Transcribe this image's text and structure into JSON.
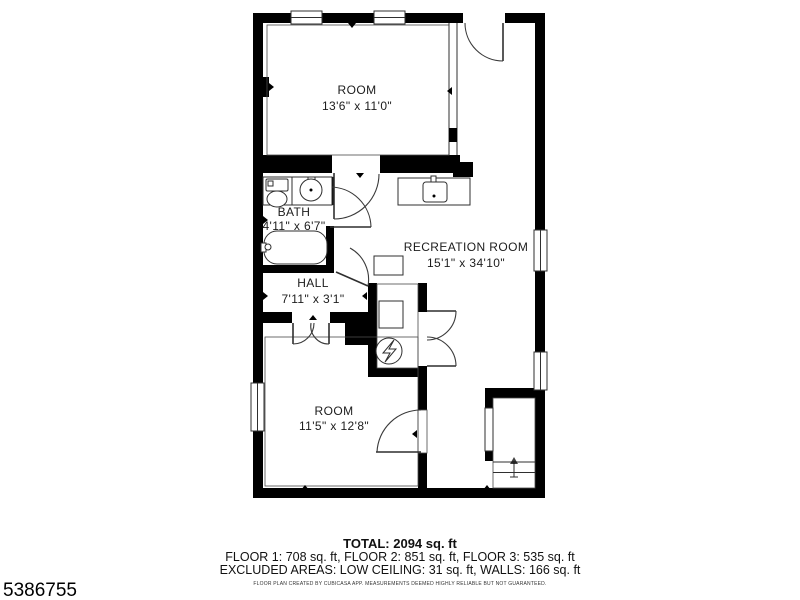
{
  "page": {
    "background": "#ffffff",
    "id_text": "5386755"
  },
  "floor_plan": {
    "wall_color": "#000000",
    "line_color": "#2f2f2f",
    "rooms": [
      {
        "name": "ROOM",
        "dimensions": "13'6\" x 11'0\""
      },
      {
        "name": "BATH",
        "dimensions": "4'11\" x 6'7\""
      },
      {
        "name": "RECREATION ROOM",
        "dimensions": "15'1\" x 34'10\""
      },
      {
        "name": "HALL",
        "dimensions": "7'11\" x 3'1\""
      },
      {
        "name": "ROOM",
        "dimensions": "11'5\" x 12'8\""
      }
    ],
    "icons": [
      "toilet-icon",
      "bathroom-sink-icon",
      "bathtub-icon",
      "kitchen-sink-icon",
      "washer-icon",
      "water-heater-icon",
      "stairs-up-icon",
      "door-swing-icon",
      "window-icon"
    ]
  },
  "summary": {
    "total": "TOTAL: 2094 sq. ft",
    "floors": "FLOOR 1: 708 sq. ft, FLOOR 2: 851 sq. ft, FLOOR 3: 535 sq. ft",
    "excluded_areas": "EXCLUDED AREAS: LOW CEILING: 31 sq. ft, WALLS: 166 sq. ft",
    "disclaimer": "FLOOR PLAN CREATED BY CUBICASA APP. MEASUREMENTS DEEMED HIGHLY RELIABLE BUT NOT GUARANTEED."
  }
}
